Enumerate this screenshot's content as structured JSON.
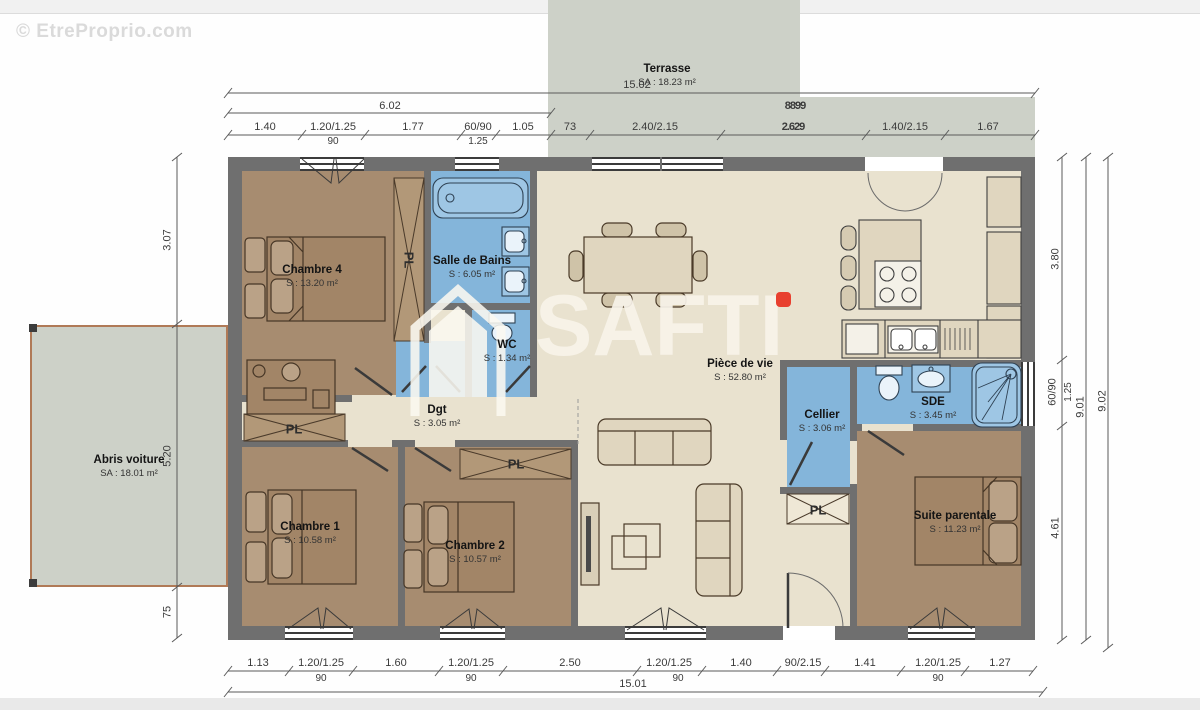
{
  "watermark": {
    "site": "© EtreProprio.com",
    "brand": "SAFTI"
  },
  "exterior": {
    "terrasse_name": "Terrasse",
    "terrasse_area": "SA : 18.23 m²",
    "abris_name": "Abris voiture",
    "abris_area": "SA : 18.01 m²"
  },
  "rooms": {
    "chambre4": {
      "name": "Chambre 4",
      "area": "S : 13.20 m²"
    },
    "sdb": {
      "name": "Salle de Bains",
      "area": "S : 6.05 m²"
    },
    "wc": {
      "name": "WC",
      "area": "S : 1.34 m²"
    },
    "dgt": {
      "name": "Dgt",
      "area": "S : 3.05 m²"
    },
    "chambre1": {
      "name": "Chambre 1",
      "area": "S : 10.58 m²"
    },
    "chambre2": {
      "name": "Chambre 2",
      "area": "S : 10.57 m²"
    },
    "sejour": {
      "name": "Pièce de vie",
      "area": "S : 52.80 m²"
    },
    "cellier": {
      "name": "Cellier",
      "area": "S : 3.06 m²"
    },
    "sde": {
      "name": "SDE",
      "area": "S : 3.45 m²"
    },
    "suite": {
      "name": "Suite parentale",
      "area": "S : 11.23 m²"
    }
  },
  "closet": "PL",
  "dims": {
    "top_overall": "15.02",
    "top_left": "6.02",
    "top_overlap": "8899",
    "top": [
      "1.40",
      "1.20/1.25",
      "1.77",
      "60/90",
      "1.05",
      "73",
      "2.40/2.15",
      "2.629",
      "1.40/2.15",
      "1.67"
    ],
    "top_sub_90": "90",
    "top_sub_125": "1.25",
    "bottom_overall": "15.01",
    "bottom": [
      "1.13",
      "1.20/1.25",
      "1.60",
      "1.20/1.25",
      "2.50",
      "1.20/1.25",
      "1.40",
      "90/2.15",
      "1.41",
      "1.20/1.25",
      "1.27"
    ],
    "bottom_sub": "90",
    "left": [
      "3.07",
      "5.20",
      "75"
    ],
    "right": [
      "3.80",
      "60/90",
      "1.25",
      "4.61",
      "9.01",
      "9.02"
    ]
  },
  "colors": {
    "wall": "#6f6f6f",
    "floor": "#e9e2cf",
    "bedroom": "#a78c70",
    "wet_room": "#84b5da",
    "terrace": "#cdd1c8",
    "brand_dot": "#e8402f"
  }
}
